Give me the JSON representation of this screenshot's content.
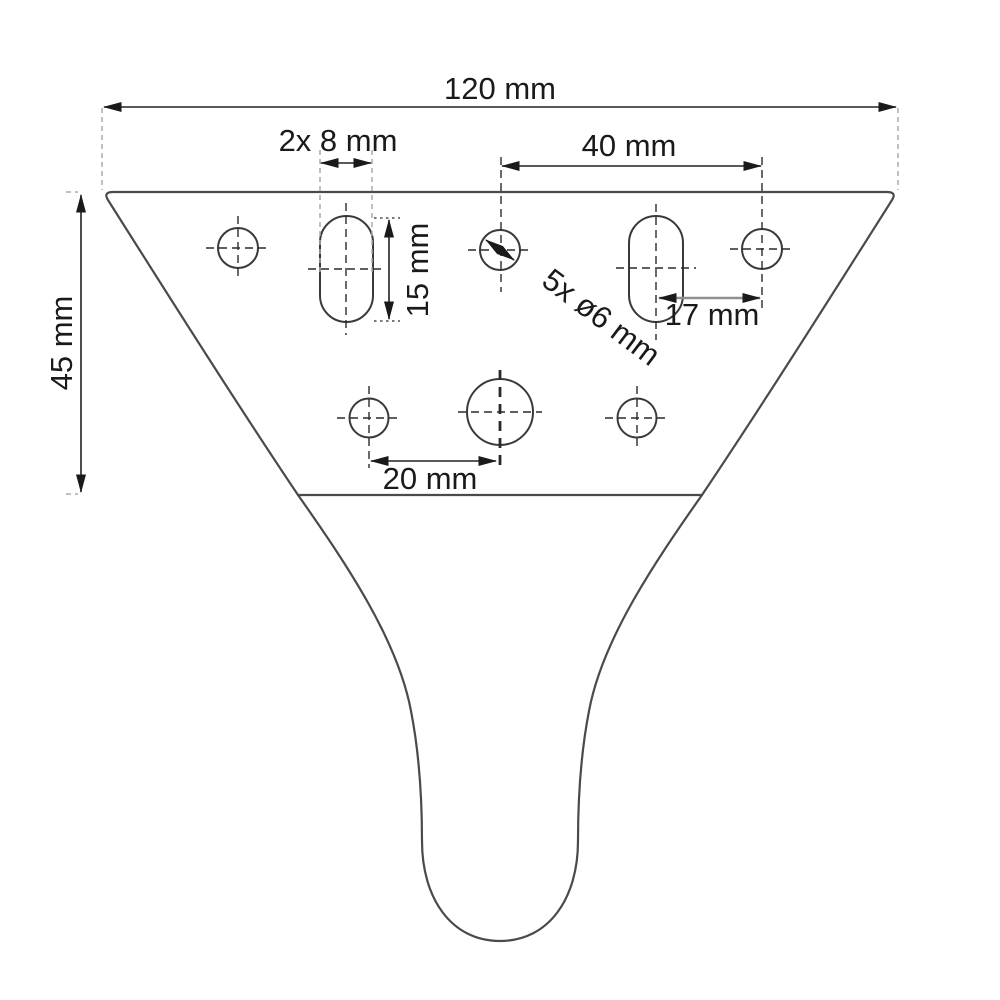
{
  "drawing": {
    "type": "technical-dimension-drawing",
    "subject": "furniture leg / mounting plate front view",
    "labels": {
      "overall_width": "120 mm",
      "slot_count_width": "2x 8 mm",
      "top_hole_spacing": "40 mm",
      "slot_height": "15 mm",
      "hole_diameter": "5x ø6 mm",
      "slot_to_hole_offset": "17 mm",
      "middle_hole_spacing": "20 mm",
      "plate_height": "45 mm"
    },
    "colors": {
      "outline": "#4a4a4a",
      "dimension_line": "#222222",
      "centerline": "#2a2a2a",
      "extension_line": "#ababab",
      "gray_dimension_line": "#8f8f8f",
      "text": "#1a1a1a",
      "background": "#ffffff"
    },
    "features": {
      "small_holes": "5 holes ø6 mm",
      "slots": "2 slots 8 x 15 mm",
      "large_center_hole": "1 unlabeled center hole",
      "overall": "120 mm wide, plate 45 mm tall, curved tapering leg below"
    }
  }
}
